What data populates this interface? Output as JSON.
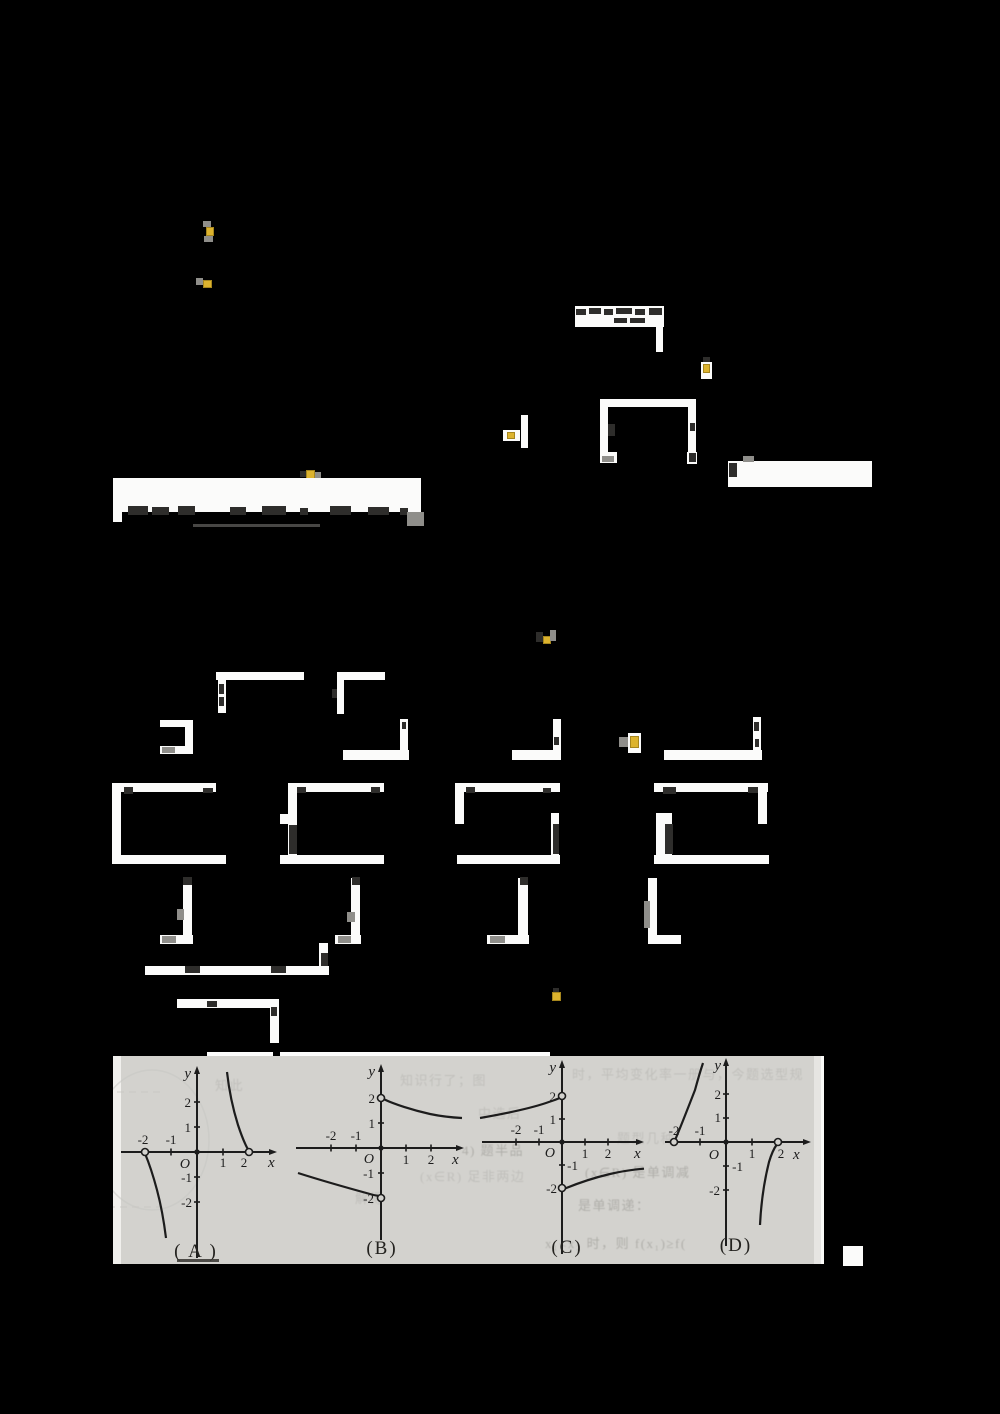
{
  "colors": {
    "page_background": "#000000",
    "band_background": "#d3d2ce",
    "ink": "#1c1c1c",
    "highlight_yellow": "#dcb32e",
    "fragment_white": "#fbfbfa"
  },
  "graphs": [
    {
      "caption": "( A )",
      "labels": {
        "y": "y",
        "x": "x",
        "o": "O"
      },
      "ticks": {
        "xn1": "-2",
        "xn2": "-1",
        "xp1": "1",
        "xp2": "2",
        "yp1": "2",
        "yp2": "1",
        "yn1": "-1",
        "yn2": "-2"
      }
    },
    {
      "caption": "(B)",
      "labels": {
        "y": "y",
        "x": "x",
        "o": "O"
      },
      "ticks": {
        "xn1": "-2",
        "xn2": "-1",
        "xp1": "1",
        "xp2": "2",
        "yp1": "2",
        "yp2": "1",
        "yn1": "-1",
        "yn2": "-2"
      }
    },
    {
      "caption": "(C)",
      "labels": {
        "y": "y",
        "x": "x",
        "o": "O"
      },
      "ticks": {
        "xn1": "-2",
        "xn2": "-1",
        "xp1": "1",
        "xp2": "2",
        "yp1": "2",
        "yp2": "1",
        "yn1": "-1",
        "yn2": "-2"
      }
    },
    {
      "caption": "(D)",
      "labels": {
        "y": "y",
        "x": "x",
        "o": "O"
      },
      "ticks": {
        "xn1": "-2",
        "xn2": "-1",
        "xp1": "1",
        "xp2": "2",
        "yp1": "2",
        "yp2": "1",
        "yn1": "-1",
        "yn2": "-2"
      }
    }
  ],
  "bleedthrough": [
    {
      "text": "时，平均变化率一册与，今题选型规"
    },
    {
      "text": "知识行了；图"
    },
    {
      "text": "中选后"
    },
    {
      "text": "题型几种"
    },
    {
      "text": "4) 题半品"
    },
    {
      "text": "(x∈R) 是单调减"
    },
    {
      "text": "(x∈R) 足非两边"
    },
    {
      "text": "是单调递："
    },
    {
      "text": "x₁<x₂ 时，则 f(x₁)≥f("
    },
    {
      "text": "解得"
    },
    {
      "text": "知此"
    }
  ],
  "chart_data": [
    {
      "label": "(A)",
      "type": "line",
      "x_ticks": [
        -2,
        -1,
        1,
        2
      ],
      "y_ticks": [
        -2,
        -1,
        1,
        2
      ],
      "open_points": [
        [
          -2,
          0
        ],
        [
          2,
          0
        ]
      ],
      "origin_dot": true,
      "branches": [
        {
          "points": [
            [
              -2,
              0
            ],
            [
              -1.8,
              -0.6
            ],
            [
              -1.5,
              -1.6
            ],
            [
              -1.2,
              -3.2
            ]
          ],
          "trend": "decreasing, falls to -inf near x=-1.1"
        },
        {
          "points": [
            [
              1.15,
              3.2
            ],
            [
              1.4,
              1.9
            ],
            [
              1.7,
              0.7
            ],
            [
              2,
              0
            ]
          ],
          "trend": "decreasing, comes from +inf near x=1.1"
        }
      ]
    },
    {
      "label": "(B)",
      "type": "line",
      "x_ticks": [
        -2,
        -1,
        1,
        2
      ],
      "y_ticks": [
        -2,
        -1,
        1,
        2
      ],
      "open_points": [
        [
          0,
          2
        ],
        [
          0,
          -2
        ]
      ],
      "origin_dot": true,
      "branches": [
        {
          "points": [
            [
              0,
              2
            ],
            [
              1,
              1.6
            ],
            [
              2,
              1.35
            ],
            [
              3.2,
              1.2
            ]
          ],
          "trend": "decreasing toward asymptote y=1"
        },
        {
          "points": [
            [
              -3.3,
              -1
            ],
            [
              -2,
              -1.3
            ],
            [
              -1,
              -1.6
            ],
            [
              0,
              -2
            ]
          ],
          "trend": "decreasing from asymptote y=-1"
        }
      ]
    },
    {
      "label": "(C)",
      "type": "line",
      "x_ticks": [
        -2,
        -1,
        1,
        2
      ],
      "y_ticks": [
        -2,
        -1,
        1,
        2
      ],
      "open_points": [
        [
          0,
          2
        ],
        [
          0,
          -2
        ]
      ],
      "origin_dot": true,
      "branches": [
        {
          "points": [
            [
              -3.5,
              1.1
            ],
            [
              -2,
              1.35
            ],
            [
              -1,
              1.6
            ],
            [
              0,
              2
            ]
          ],
          "trend": "increasing up to (0,2), from asymptote y=1"
        },
        {
          "points": [
            [
              0,
              -2
            ],
            [
              1,
              -1.6
            ],
            [
              2,
              -1.35
            ],
            [
              3.5,
              -1.2
            ]
          ],
          "trend": "increasing toward asymptote y=-1"
        }
      ]
    },
    {
      "label": "(D)",
      "type": "line",
      "x_ticks": [
        -2,
        -1,
        1,
        2
      ],
      "y_ticks": [
        -2,
        -1,
        1,
        2
      ],
      "open_points": [
        [
          -2,
          0
        ],
        [
          2,
          0
        ]
      ],
      "origin_dot": true,
      "branches": [
        {
          "points": [
            [
              -2,
              0
            ],
            [
              -1.5,
              1
            ],
            [
              -1.1,
              2.2
            ],
            [
              -0.85,
              3.2
            ]
          ],
          "trend": "increasing, rises to +inf near x=-0.85"
        },
        {
          "points": [
            [
              1.3,
              -3.3
            ],
            [
              1.5,
              -1.8
            ],
            [
              1.8,
              -0.6
            ],
            [
              2,
              0
            ]
          ],
          "trend": "increasing, comes from -inf near x=1.25"
        }
      ]
    }
  ]
}
